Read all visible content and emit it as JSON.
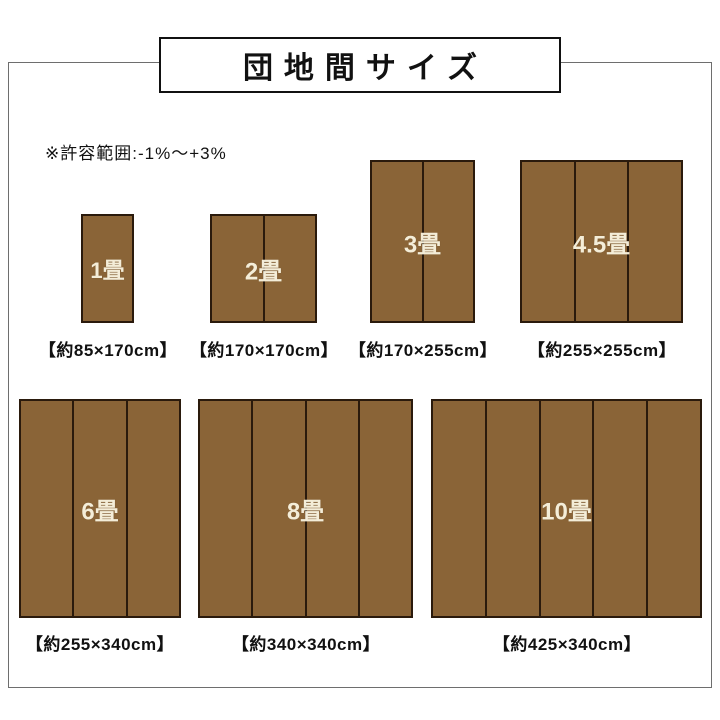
{
  "title": "団地間サイズ",
  "note": "※許容範囲:-1%〜+3%",
  "colors": {
    "mat_fill": "#8a6437",
    "mat_border": "#2a1a0c",
    "mat_label": "#f4edd8",
    "frame_border": "#6e6e6e",
    "title_border": "#111111",
    "text": "#111111",
    "background": "#ffffff"
  },
  "mats": [
    {
      "label": "1畳",
      "dimensions": "【約85×170cm】",
      "panels": 1
    },
    {
      "label": "2畳",
      "dimensions": "【約170×170cm】",
      "panels": 2
    },
    {
      "label": "3畳",
      "dimensions": "【約170×255cm】",
      "panels": 2
    },
    {
      "label": "4.5畳",
      "dimensions": "【約255×255cm】",
      "panels": 3
    },
    {
      "label": "6畳",
      "dimensions": "【約255×340cm】",
      "panels": 3
    },
    {
      "label": "8畳",
      "dimensions": "【約340×340cm】",
      "panels": 4
    },
    {
      "label": "10畳",
      "dimensions": "【約425×340cm】",
      "panels": 5
    }
  ]
}
